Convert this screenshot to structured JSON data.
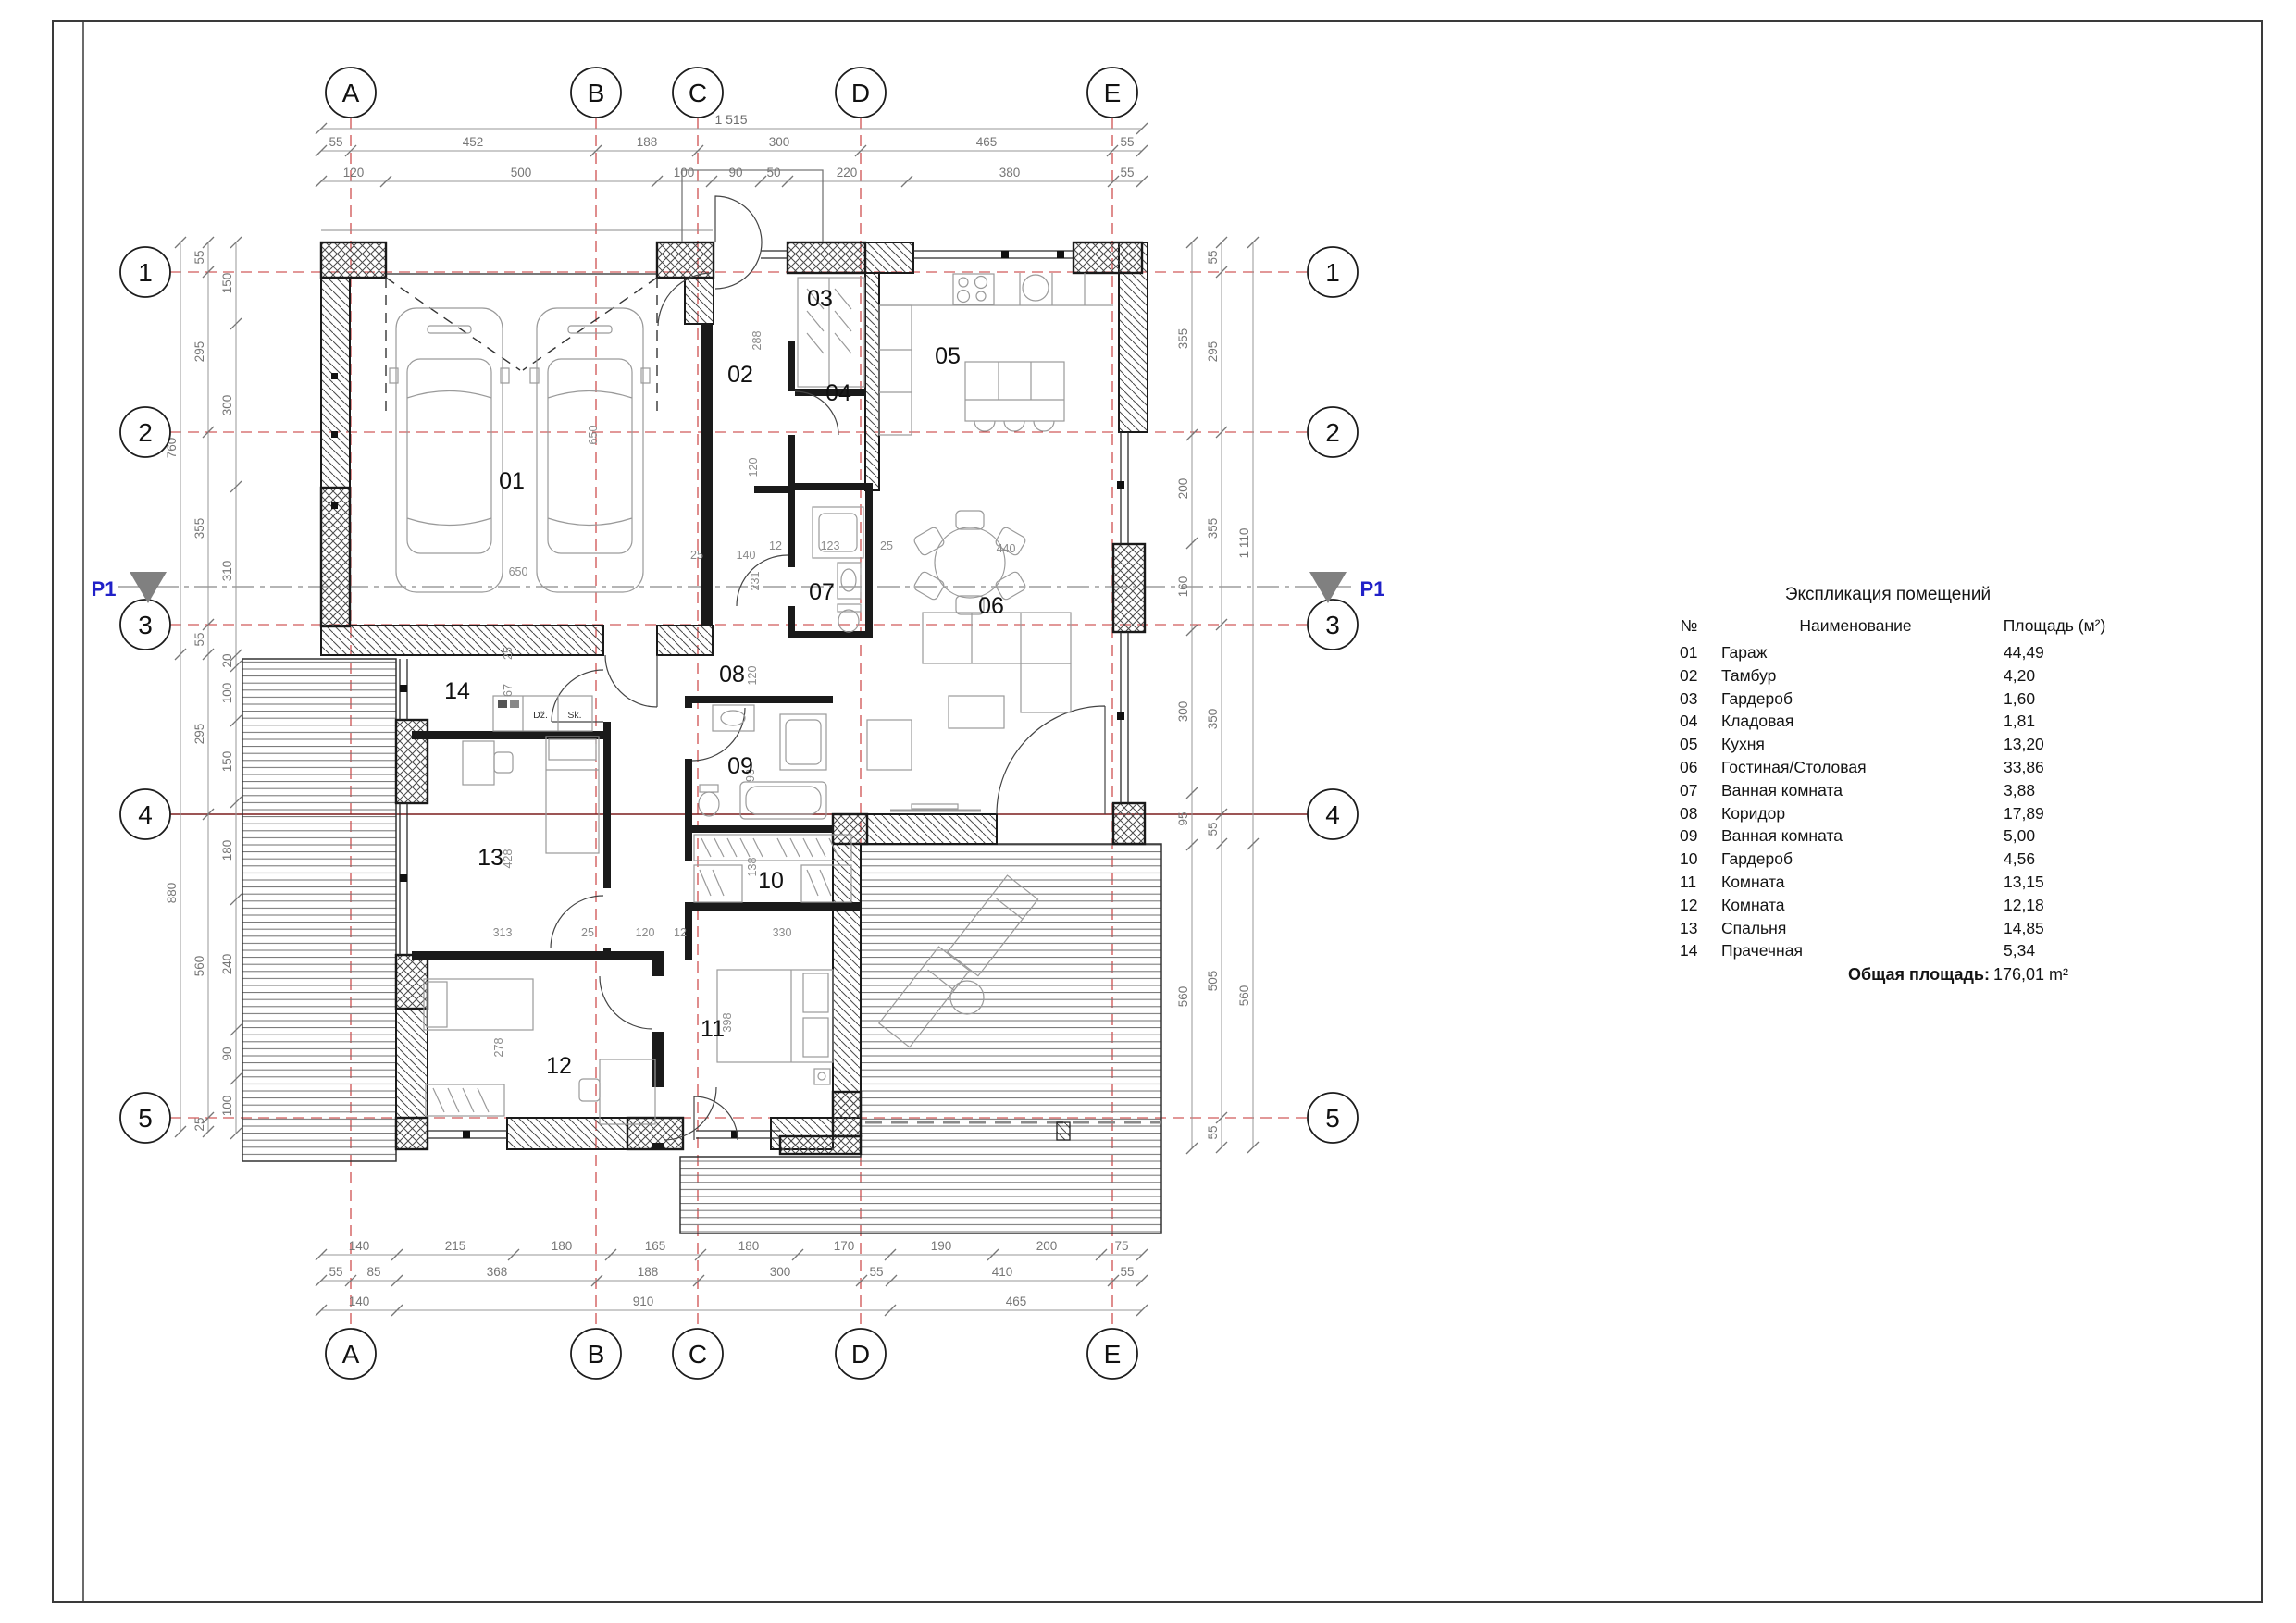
{
  "sheet": {
    "type": "floor-plan-drawing"
  },
  "grid": {
    "cols": [
      "A",
      "B",
      "C",
      "D",
      "E"
    ],
    "rows": [
      "1",
      "2",
      "3",
      "4",
      "5"
    ]
  },
  "section_marker": {
    "label": "P1"
  },
  "dims": {
    "top1": "1 515",
    "top2": [
      "55",
      "452",
      "188",
      "300",
      "465",
      "55"
    ],
    "top3": [
      "120",
      "500",
      "100",
      "90",
      "50",
      "220",
      "380",
      "55"
    ],
    "bottom1": [
      "140",
      "215",
      "180",
      "165",
      "180",
      "170",
      "190",
      "200",
      "75"
    ],
    "bottom2": [
      "55",
      "85",
      "368",
      "188",
      "300",
      "55",
      "410",
      "55"
    ],
    "bottom3": [
      "140",
      "910",
      "465"
    ],
    "left_outer": [
      "760",
      "880"
    ],
    "left_mid": [
      "55",
      "295",
      "355",
      "55",
      "295",
      "560",
      "25"
    ],
    "left_inner": [
      "150",
      "300",
      "310",
      "20",
      "100",
      "150",
      "180",
      "240",
      "90",
      "100"
    ],
    "right_inner": [
      "355",
      "200",
      "160",
      "300",
      "95",
      "560"
    ],
    "right_mid": [
      "55",
      "295",
      "355",
      "350",
      "55",
      "505",
      "55"
    ],
    "right_outer": [
      "1 110",
      "560"
    ],
    "interior": {
      "g650v": "650",
      "g650h": "650",
      "g25": "25",
      "g140": "140",
      "t288": "288",
      "t120": "120",
      "c231": "231",
      "b12": "12",
      "b123": "123",
      "b25": "25",
      "d440": "440",
      "h120": "120",
      "h93": "93",
      "h138": "138",
      "v25": "25",
      "v67": "67",
      "v428": "428",
      "v278": "278",
      "v398": "398",
      "p313": "313",
      "p25": "25",
      "p120": "120",
      "p12": "12",
      "p330": "330"
    }
  },
  "rooms": {
    "r01": "01",
    "r02": "02",
    "r03": "03",
    "r04": "04",
    "r05": "05",
    "r06": "06",
    "r07": "07",
    "r08": "08",
    "r09": "09",
    "r10": "10",
    "r11": "11",
    "r12": "12",
    "r13": "13",
    "r14": "14"
  },
  "appliances": {
    "washer": "Dž.",
    "dryer": "Sk."
  },
  "legend": {
    "title": "Экспликация помещений",
    "col_no": "№",
    "col_name": "Наименование",
    "col_area": "Площадь (м²)",
    "rows": [
      [
        "01",
        "Гараж",
        "44,49"
      ],
      [
        "02",
        "Тамбур",
        "4,20"
      ],
      [
        "03",
        "Гардероб",
        "1,60"
      ],
      [
        "04",
        "Кладовая",
        "1,81"
      ],
      [
        "05",
        "Кухня",
        "13,20"
      ],
      [
        "06",
        "Гостиная/Столовая",
        "33,86"
      ],
      [
        "07",
        "Ванная комната",
        "3,88"
      ],
      [
        "08",
        "Коридор",
        "17,89"
      ],
      [
        "09",
        "Ванная комната",
        "5,00"
      ],
      [
        "10",
        "Гардероб",
        "4,56"
      ],
      [
        "11",
        "Комната",
        "13,15"
      ],
      [
        "12",
        "Комната",
        "12,18"
      ],
      [
        "13",
        "Спальня",
        "14,85"
      ],
      [
        "14",
        "Прачечная",
        "5,34"
      ]
    ],
    "total_label": "Общая площадь:",
    "total_value": "176,01 m²"
  },
  "colors": {
    "axis_red": "#c53030",
    "axis_dark_red": "#7c1d1d",
    "wall": "#1a1a1a",
    "dim_gray": "#767676",
    "p1_blue": "#2121c8"
  }
}
